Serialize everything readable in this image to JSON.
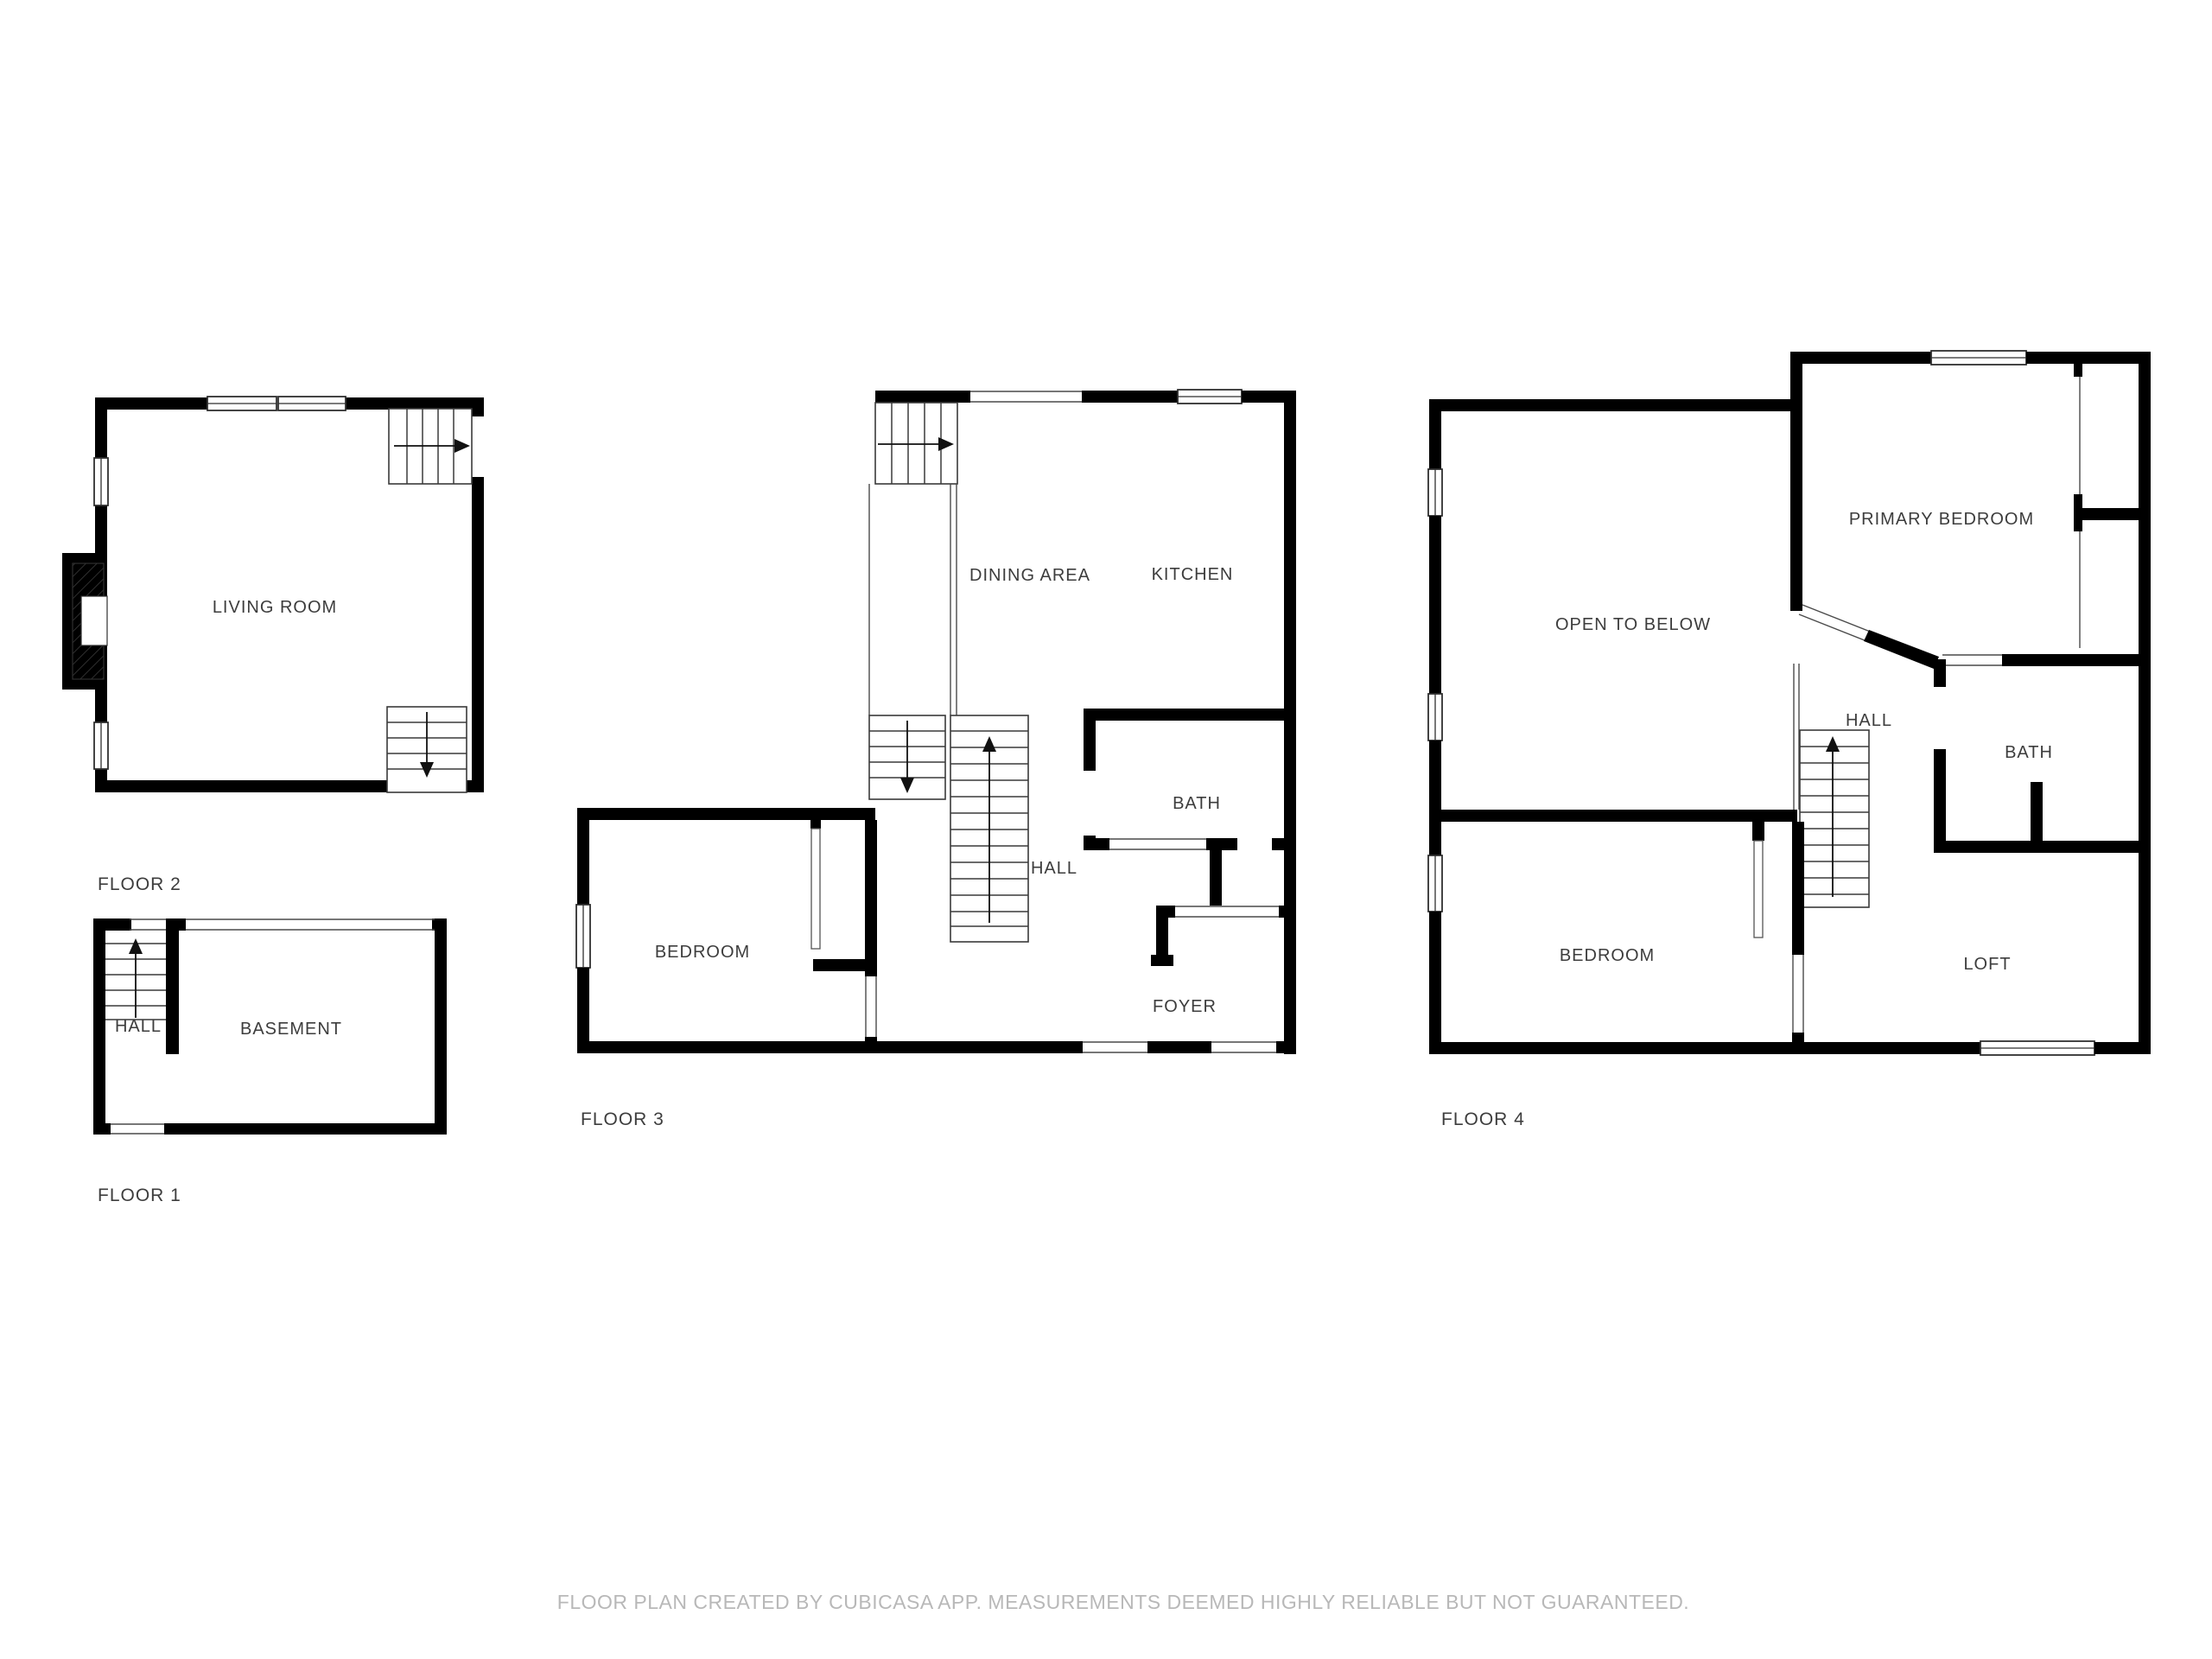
{
  "sheet": {
    "background": "#ffffff",
    "wall_color": "#000000",
    "label_color": "#3d3d3d",
    "disclaimer_color": "#b8b8b8"
  },
  "floors": {
    "floor1": {
      "title": "FLOOR 1",
      "rooms": {
        "hall": "HALL",
        "basement": "BASEMENT"
      }
    },
    "floor2": {
      "title": "FLOOR 2",
      "rooms": {
        "living_room": "LIVING ROOM"
      }
    },
    "floor3": {
      "title": "FLOOR 3",
      "rooms": {
        "dining_area": "DINING AREA",
        "kitchen": "KITCHEN",
        "bedroom": "BEDROOM",
        "bath": "BATH",
        "hall": "HALL",
        "foyer": "FOYER"
      }
    },
    "floor4": {
      "title": "FLOOR 4",
      "rooms": {
        "open_to_below": "OPEN TO BELOW",
        "primary_bedroom": "PRIMARY BEDROOM",
        "bedroom": "BEDROOM",
        "bath": "BATH",
        "hall": "HALL",
        "loft": "LOFT"
      }
    }
  },
  "footer": {
    "disclaimer": "FLOOR PLAN CREATED BY CUBICASA APP. MEASUREMENTS DEEMED HIGHLY RELIABLE BUT NOT GUARANTEED."
  }
}
